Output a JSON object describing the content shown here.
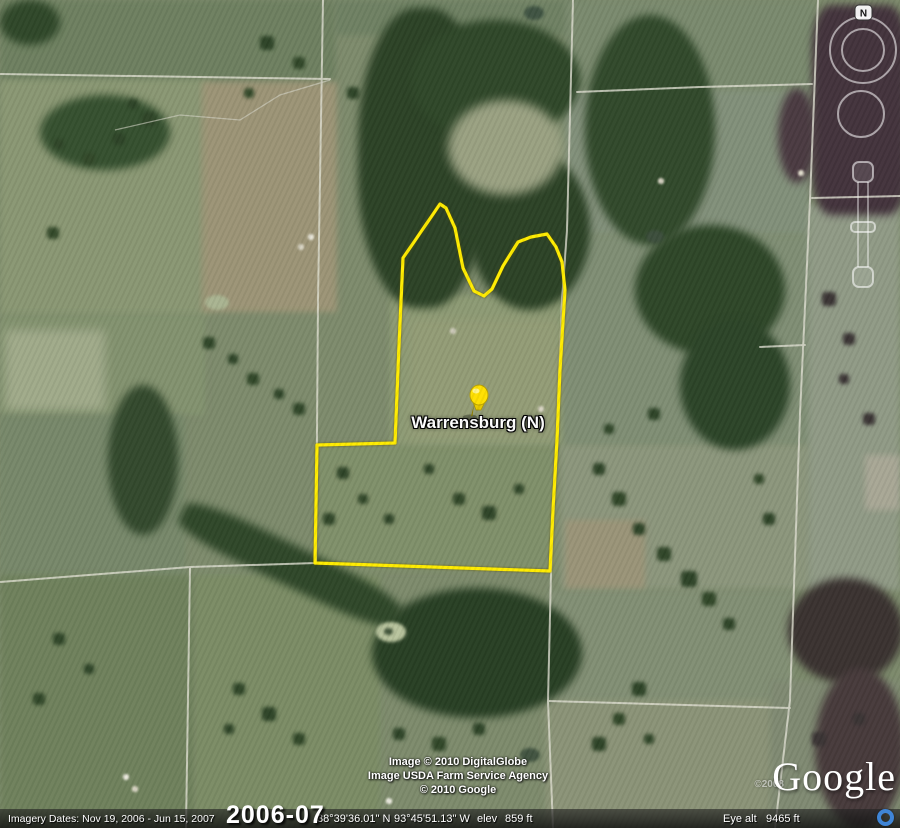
{
  "placemark": {
    "label": "Warrensburg (N)"
  },
  "boundary": {
    "color": "#ffec00",
    "points": "440,204 446,208 455,228 463,268 474,291 484,296 492,289 503,266 518,242 531,237 547,234 556,247 562,262 565,290 560,370 557,440 553,510 550,571 315,563 317,445 395,443 399,345 403,258 440,204"
  },
  "navigation": {
    "north_label": "N"
  },
  "attribution": {
    "line1": "Image © 2010 DigitalGlobe",
    "line2": "Image USDA Farm Service Agency",
    "line3": "© 2010 Google",
    "watermark": "©2008",
    "logo_text": "Google"
  },
  "status_bar": {
    "imagery_dates": "Imagery Dates: Nov 19, 2006 - Jun 15, 2007",
    "date_range": "2006-07",
    "latitude": "38°39'36.01\" N",
    "longitude": "93°45'51.13\" W",
    "elev_label": "elev",
    "elev_value": "859 ft",
    "eye_alt_label": "Eye alt",
    "eye_alt_value": "9465 ft"
  }
}
